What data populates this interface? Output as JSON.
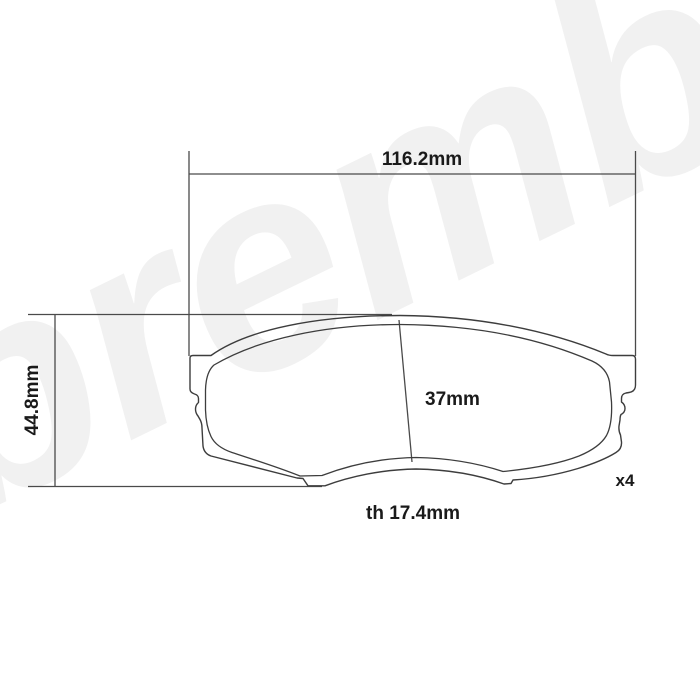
{
  "diagram": {
    "title": "brake-pad-technical-drawing",
    "watermark_text": "brembo",
    "labels": {
      "overall_width": "116.2mm",
      "overall_height": "44.8mm",
      "pad_height": "37mm",
      "thickness": "th 17.4mm",
      "quantity": "x4"
    },
    "colors": {
      "background": "#ffffff",
      "outline": "#3d3d3d",
      "dimension_line": "#4a4a4a",
      "text": "#1a1a1a",
      "watermark": "#f1f1f1"
    }
  }
}
